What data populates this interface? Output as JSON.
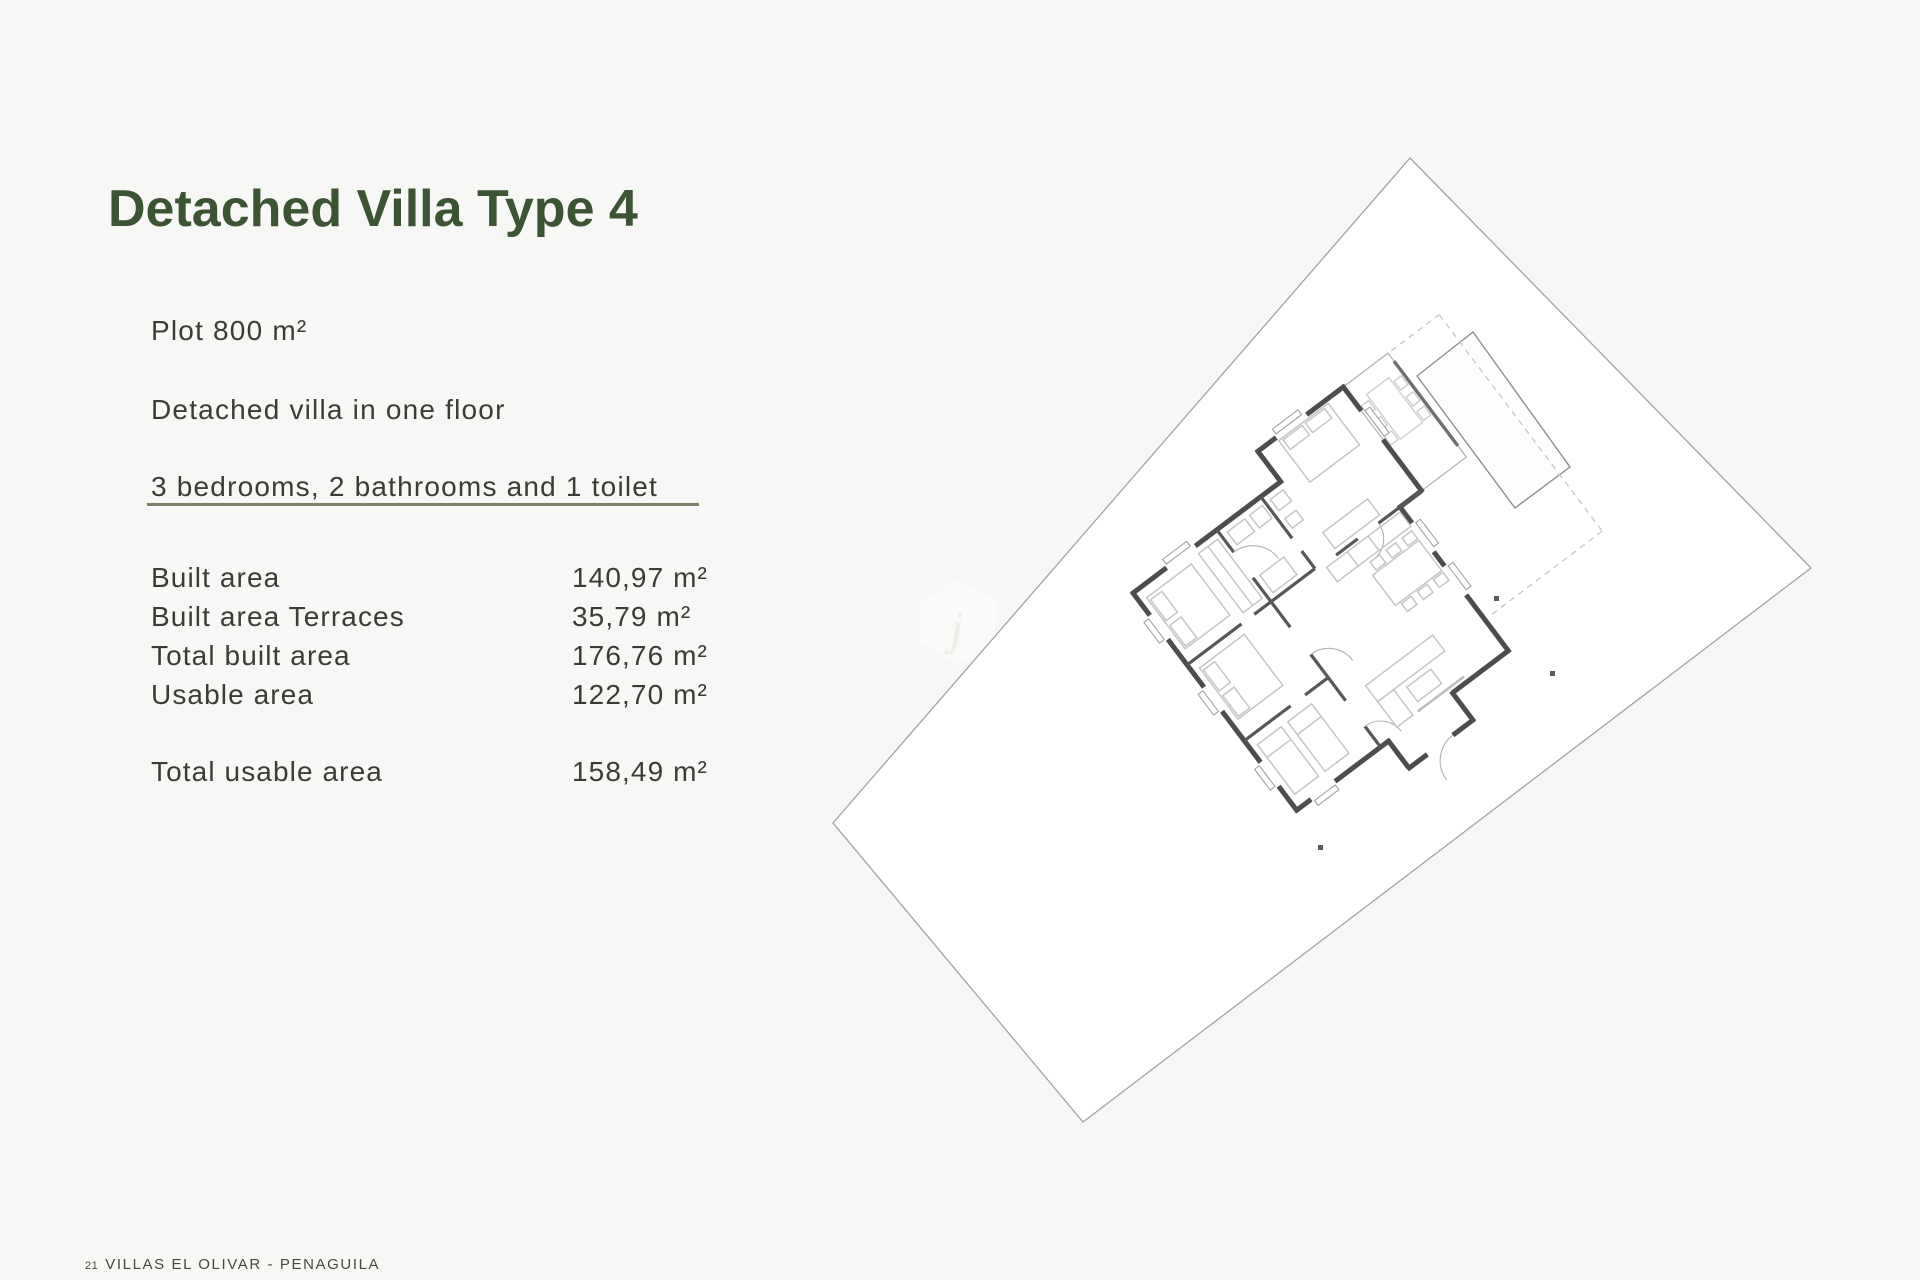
{
  "header": {
    "title": "Detached Villa Type 4"
  },
  "intro": {
    "plot": "Plot 800 m²",
    "floors": "Detached villa in one floor",
    "rooms": "3 bedrooms, 2 bathrooms and 1 toilet"
  },
  "specs": {
    "rows": [
      {
        "label": "Built area",
        "value": "140,97 m²"
      },
      {
        "label": "Built area Terraces",
        "value": "35,79 m²"
      },
      {
        "label": "Total built area",
        "value": "176,76 m²"
      },
      {
        "label": "Usable area",
        "value": "122,70 m²"
      }
    ],
    "total": {
      "label": "Total usable area",
      "value": "158,49 m²"
    }
  },
  "footer": {
    "page_number": "21",
    "project_name": "VILLAS EL OLIVAR - PENAGUILA"
  },
  "plan": {
    "elements": [
      "plot-boundary",
      "swimming-pool",
      "villa-floor-plan",
      "terrace-dashed-boundary",
      "survey-marker-dots",
      "hex-watermark"
    ]
  },
  "colors": {
    "title_green": "#3c5433",
    "divider_olive": "#7f7f68",
    "body_text": "#3b3b38",
    "footer_text": "#45493f",
    "wall_gray": "#4d4d4d",
    "plot_line_gray": "#a3a3a3",
    "page_background": "#f7f7f5",
    "plot_fill": "#ffffff"
  }
}
